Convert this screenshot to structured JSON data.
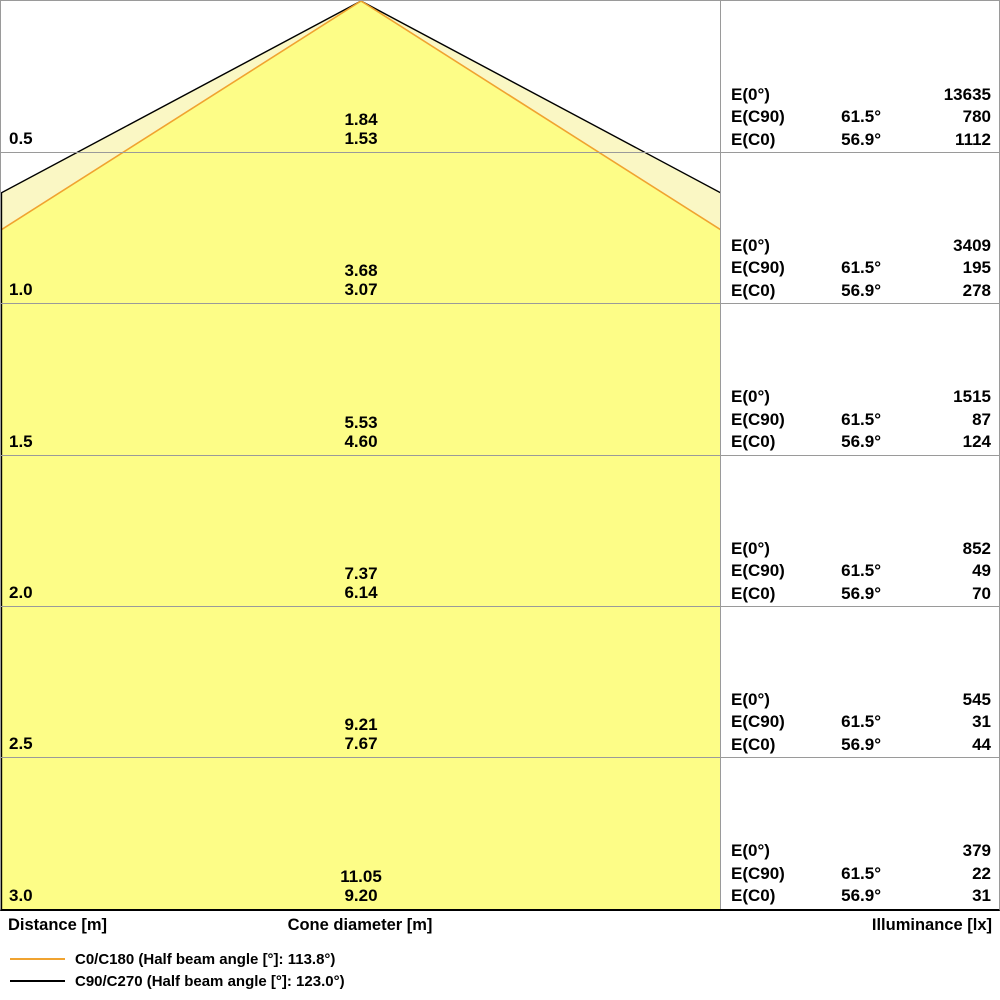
{
  "colors": {
    "inner_fill": "#FDFD87",
    "outer_fill": "#FAF7C4",
    "c0_line": "#F0A330",
    "c90_line": "#000000",
    "grid_line": "#9a9a9a"
  },
  "footer": {
    "distance_header": "Distance [m]",
    "cone_diameter_header": "Cone diameter [m]",
    "illuminance_header": "Illuminance [lx]"
  },
  "legend": [
    {
      "label": "C0/C180 (Half beam angle [°]: 113.8°)",
      "color": "#F0A330"
    },
    {
      "label": "C90/C270 (Half beam angle [°]: 123.0°)",
      "color": "#000000"
    }
  ],
  "rows": [
    {
      "distance": "0.5",
      "cone_c90": "1.84",
      "cone_c0": "1.53",
      "e0_label": "E(0°)",
      "ec90_label": "E(C90)",
      "ec0_label": "E(C0)",
      "ec90_angle": "61.5°",
      "ec0_angle": "56.9°",
      "e0": "13635",
      "ec90": "780",
      "ec0": "1112"
    },
    {
      "distance": "1.0",
      "cone_c90": "3.68",
      "cone_c0": "3.07",
      "e0_label": "E(0°)",
      "ec90_label": "E(C90)",
      "ec0_label": "E(C0)",
      "ec90_angle": "61.5°",
      "ec0_angle": "56.9°",
      "e0": "3409",
      "ec90": "195",
      "ec0": "278"
    },
    {
      "distance": "1.5",
      "cone_c90": "5.53",
      "cone_c0": "4.60",
      "e0_label": "E(0°)",
      "ec90_label": "E(C90)",
      "ec0_label": "E(C0)",
      "ec90_angle": "61.5°",
      "ec0_angle": "56.9°",
      "e0": "1515",
      "ec90": "87",
      "ec0": "124"
    },
    {
      "distance": "2.0",
      "cone_c90": "7.37",
      "cone_c0": "6.14",
      "e0_label": "E(0°)",
      "ec90_label": "E(C90)",
      "ec0_label": "E(C0)",
      "ec90_angle": "61.5°",
      "ec0_angle": "56.9°",
      "e0": "852",
      "ec90": "49",
      "ec0": "70"
    },
    {
      "distance": "2.5",
      "cone_c90": "9.21",
      "cone_c0": "7.67",
      "e0_label": "E(0°)",
      "ec90_label": "E(C90)",
      "ec0_label": "E(C0)",
      "ec90_angle": "61.5°",
      "ec0_angle": "56.9°",
      "e0": "545",
      "ec90": "31",
      "ec0": "44"
    },
    {
      "distance": "3.0",
      "cone_c90": "11.05",
      "cone_c0": "9.20",
      "e0_label": "E(0°)",
      "ec90_label": "E(C90)",
      "ec0_label": "E(C0)",
      "ec90_angle": "61.5°",
      "ec0_angle": "56.9°",
      "e0": "379",
      "ec90": "22",
      "ec0": "31"
    }
  ],
  "chart_data": {
    "type": "area",
    "title": "Luminaire light cone diagram",
    "ylabel": "Distance [m]",
    "xlabel": "Cone diameter [m]",
    "value_label": "Illuminance [lx]",
    "distances_m": [
      0.5,
      1.0,
      1.5,
      2.0,
      2.5,
      3.0
    ],
    "series": [
      {
        "name": "C0/C180",
        "half_beam_angle_deg": 113.8,
        "color": "#F0A330",
        "cone_diameter_m": [
          1.53,
          3.07,
          4.6,
          6.14,
          7.67,
          9.2
        ]
      },
      {
        "name": "C90/C270",
        "half_beam_angle_deg": 123.0,
        "color": "#000000",
        "cone_diameter_m": [
          1.84,
          3.68,
          5.53,
          7.37,
          9.21,
          11.05
        ]
      }
    ],
    "illuminance_lx": [
      {
        "distance_m": 0.5,
        "E0": 13635,
        "EC90": 780,
        "EC0": 1112
      },
      {
        "distance_m": 1.0,
        "E0": 3409,
        "EC90": 195,
        "EC0": 278
      },
      {
        "distance_m": 1.5,
        "E0": 1515,
        "EC90": 87,
        "EC0": 124
      },
      {
        "distance_m": 2.0,
        "E0": 852,
        "EC90": 49,
        "EC0": 70
      },
      {
        "distance_m": 2.5,
        "E0": 545,
        "EC90": 31,
        "EC0": 44
      },
      {
        "distance_m": 3.0,
        "E0": 379,
        "EC90": 22,
        "EC0": 31
      }
    ],
    "angles": {
      "EC90": "61.5°",
      "EC0": "56.9°"
    },
    "legend_position": "bottom-left",
    "grid": true
  }
}
